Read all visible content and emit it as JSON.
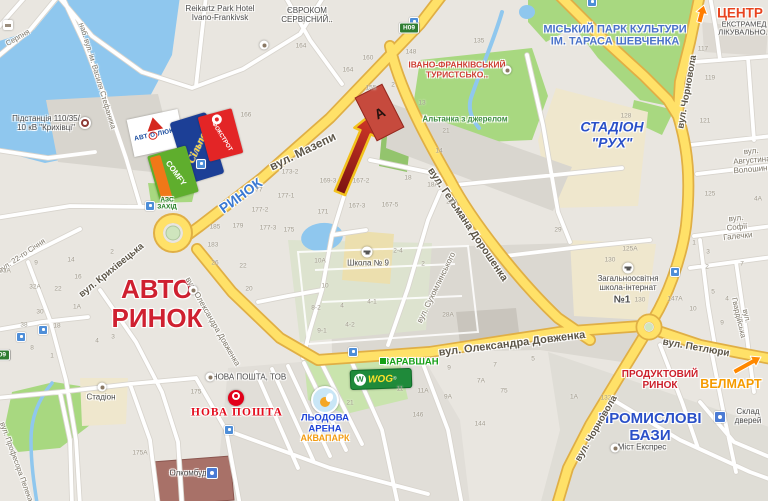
{
  "marker": {
    "letter": "А"
  },
  "colors": {
    "water": "#8fc7ee",
    "park": "#a8d880",
    "road_major": "#ffe168",
    "road_major_casing": "#e0af45",
    "road_minor": "#ffffff",
    "land": "#e9e6e0",
    "tan_poi": "#efe7cd",
    "accent_red": "#cf2030",
    "accent_blue": "#2a50c8",
    "accent_orange": "#ff7d00"
  },
  "area_labels": [
    {
      "name": "park-shevchenko-label",
      "text": "МІСЬКИЙ ПАРК КУЛЬТУРИ\nІМ. ТАРАСА ШЕВЧЕНКА",
      "x": 615,
      "y": 36,
      "size": 11,
      "color": "#4a72c8"
    },
    {
      "name": "stadion-rukh-label",
      "text": "СТАДІОН\n\"РУХ\"",
      "x": 612,
      "y": 135,
      "size": 14,
      "color": "#2a50c8",
      "italic": true
    },
    {
      "name": "avto-rynok-label",
      "text": "АВТО\nРИНОК",
      "x": 157,
      "y": 304,
      "size": 26,
      "color": "#cf2030"
    },
    {
      "name": "rynok-label",
      "text": "РИНОК",
      "x": 241,
      "y": 196,
      "rot": -36,
      "size": 14,
      "color": "#3c7ad2"
    },
    {
      "name": "promyslovi-bazy-label",
      "text": "ПРОМИСЛОВІ\nБАЗИ",
      "x": 650,
      "y": 428,
      "size": 15,
      "color": "#2a50c8"
    },
    {
      "name": "produktovyi-rynok-label",
      "text": "ПРОДУКТОВИЙ\nРИНОК",
      "x": 660,
      "y": 380,
      "size": 10,
      "color": "#cc1f2a"
    },
    {
      "name": "velmart-label",
      "text": "ВЕЛМАРТ",
      "x": 731,
      "y": 384,
      "size": 12.5,
      "color": "#f59b00"
    },
    {
      "name": "centr-label",
      "text": "ЦЕНТР",
      "x": 740,
      "y": 13,
      "size": 13.5,
      "color": "#e8431e"
    },
    {
      "name": "turyst-poi-label",
      "text": "ІВАНО-ФРАНКІВСЬКИЙ\nТУРИСТСЬКО..",
      "x": 457,
      "y": 70,
      "size": 8.5,
      "color": "#ce3e33"
    },
    {
      "name": "altanka-label",
      "text": "Альтанка з джерелом",
      "x": 465,
      "y": 120,
      "size": 8,
      "color": "#3e8e41"
    },
    {
      "name": "zaravshan-label",
      "text": "ЗАРАВШАН",
      "x": 411,
      "y": 363,
      "size": 9.5,
      "color": "#17a017"
    },
    {
      "name": "lodova-arena-label",
      "text": "ЛЬОДОВА\nАРЕНА",
      "x": 325,
      "y": 424,
      "size": 9.5,
      "color": "#2145d8"
    },
    {
      "name": "akvapark-label",
      "text": "АКВАПАРК",
      "x": 325,
      "y": 438,
      "size": 9,
      "color": "#f39c12"
    },
    {
      "name": "nova-poshta-label",
      "text": "НОВА ПОШТА",
      "x": 237,
      "y": 413,
      "size": 11.5,
      "color": "#e30b1c",
      "serif": true,
      "spacing": 1
    },
    {
      "name": "azs-zahid-label",
      "text": "АЗС\nЗАХІД",
      "x": 167,
      "y": 204,
      "size": 6.5,
      "color": "#1c7a1c"
    }
  ],
  "street_labels": [
    {
      "name": "street-mazepy-label",
      "text": "вул. Мазепи",
      "x": 303,
      "y": 152,
      "rot": -26,
      "size": 12
    },
    {
      "name": "street-hetmana-doroshenka-label",
      "text": "вул. Гетьмана Дорошенка",
      "x": 467,
      "y": 225,
      "rot": 56,
      "size": 10.5
    },
    {
      "name": "street-chornovola-north-label",
      "text": "вул. Чорновола",
      "x": 688,
      "y": 92,
      "rot": -80,
      "size": 9.5
    },
    {
      "name": "street-chornovola-south-label",
      "text": "вул. Чорновола",
      "x": 597,
      "y": 429,
      "rot": -60,
      "size": 9.5
    },
    {
      "name": "street-dovzhenka-label",
      "text": "вул. Олександра Довженка",
      "x": 512,
      "y": 344,
      "rot": -7,
      "size": 11
    },
    {
      "name": "street-dovzhenka-west-label",
      "text": "вул. Олександра Довженка",
      "x": 212,
      "y": 322,
      "rot": 60,
      "size": 8,
      "bold": false,
      "color": "#7d7668"
    },
    {
      "name": "street-petliury-label",
      "text": "вул. Петлюри",
      "x": 696,
      "y": 348,
      "rot": 10,
      "size": 10
    },
    {
      "name": "street-kryhivetska-label",
      "text": "вул. Крихівецька",
      "x": 112,
      "y": 271,
      "rot": -39,
      "size": 9.5
    },
    {
      "name": "street-stefanyka-label",
      "text": "наб. вул. ім. Василя Стефаника",
      "x": 97,
      "y": 76,
      "rot": 73,
      "size": 7.5,
      "bold": false,
      "color": "#7d7668"
    },
    {
      "name": "street-sukhomlynskoho-label",
      "text": "вул. Сухомлинського",
      "x": 437,
      "y": 288,
      "rot": -64,
      "size": 8,
      "bold": false,
      "color": "#7d7668"
    },
    {
      "name": "street-voloshyna-label",
      "text": "вул. Августина Волошина",
      "x": 752,
      "y": 161,
      "rot": -5,
      "size": 8,
      "bold": false,
      "color": "#7d7668"
    },
    {
      "name": "street-halechky-label",
      "text": "вул. Софії Галечки",
      "x": 737,
      "y": 228,
      "rot": -6,
      "size": 8,
      "bold": false,
      "color": "#7d7668"
    },
    {
      "name": "street-hvardiiska-label",
      "text": "вул. Гвардійська",
      "x": 742,
      "y": 317,
      "rot": 77,
      "size": 7.5,
      "bold": false,
      "color": "#7d7668"
    },
    {
      "name": "street-22-sichnya-label",
      "text": "вул. 22-го Січня",
      "x": 22,
      "y": 256,
      "rot": -34,
      "size": 7.5,
      "bold": false,
      "color": "#7d7668"
    },
    {
      "name": "street-pelekha-label",
      "text": "вул. Професора Пелека",
      "x": 16,
      "y": 462,
      "rot": 70,
      "size": 7.5,
      "bold": false,
      "color": "#7d7668"
    },
    {
      "name": "street-serpnya-label",
      "text": "Серпня",
      "x": 18,
      "y": 38,
      "rot": -30,
      "size": 7.5,
      "bold": false,
      "color": "#7d7668"
    }
  ],
  "poi_labels": [
    {
      "name": "reikartz-hotel-label",
      "text": "Reikartz Park Hotel\nIvano-Frankivsk",
      "x": 220,
      "y": 14
    },
    {
      "name": "evrokom-label",
      "text": "ЄВРОКОМ\nСЕРВІСНИЙ..",
      "x": 307,
      "y": 16
    },
    {
      "name": "ekstramed-label",
      "text": "ЕКСТРАМЕД\nЛІКУВАЛЬНО..",
      "x": 744,
      "y": 29,
      "size": 7.5
    },
    {
      "name": "pidstantsiya-label",
      "text": "Підстанція 110/35/\n10 кВ \"Крихівці\"",
      "x": 46,
      "y": 124
    },
    {
      "name": "shkola-9-label",
      "text": "Школа № 9",
      "x": 368,
      "y": 264
    },
    {
      "name": "internat-label",
      "text": "Загальноосвітня\nшкола-інтернат",
      "x": 628,
      "y": 284
    },
    {
      "name": "internat-n1-label",
      "text": "№1",
      "x": 622,
      "y": 300,
      "size": 10,
      "bold": true
    },
    {
      "name": "nova-poshta-tov-label",
      "text": "НОВА ПОШТА, ТОВ",
      "x": 249,
      "y": 378
    },
    {
      "name": "stadion-label",
      "text": "Стадіон",
      "x": 101,
      "y": 398
    },
    {
      "name": "olkombud-label",
      "text": "Олкомбуд",
      "x": 188,
      "y": 474
    },
    {
      "name": "mist-ekspres-label",
      "text": "Міст Експрес",
      "x": 642,
      "y": 448
    },
    {
      "name": "sklad-dverei-label",
      "text": "Склад дверей",
      "x": 748,
      "y": 417
    }
  ],
  "house_numbers": [
    [
      "166",
      246,
      115
    ],
    [
      "164",
      301,
      46
    ],
    [
      "160",
      368,
      58
    ],
    [
      "148",
      411,
      52
    ],
    [
      "135",
      479,
      41
    ],
    [
      "164",
      348,
      70
    ],
    [
      "155",
      371,
      88
    ],
    [
      "2",
      393,
      85
    ],
    [
      "13",
      422,
      103
    ],
    [
      "21",
      446,
      131
    ],
    [
      "14",
      439,
      151
    ],
    [
      "18А",
      433,
      185
    ],
    [
      "18",
      408,
      178
    ],
    [
      "2-4",
      398,
      251
    ],
    [
      "2",
      423,
      264
    ],
    [
      "22А",
      452,
      202
    ],
    [
      "29",
      558,
      230
    ],
    [
      "28А",
      448,
      315
    ],
    [
      "173-2",
      290,
      172
    ],
    [
      "177-1",
      286,
      196
    ],
    [
      "177-2",
      260,
      210
    ],
    [
      "177-3",
      268,
      228
    ],
    [
      "175",
      289,
      230
    ],
    [
      "169-3",
      328,
      181
    ],
    [
      "167-2",
      361,
      181
    ],
    [
      "167-3",
      357,
      206
    ],
    [
      "167-5",
      390,
      205
    ],
    [
      "171",
      323,
      212
    ],
    [
      "10А",
      320,
      261
    ],
    [
      "10",
      325,
      286
    ],
    [
      "8-2",
      316,
      308
    ],
    [
      "4",
      342,
      306
    ],
    [
      "4-1",
      372,
      302
    ],
    [
      "4-2",
      350,
      325
    ],
    [
      "9-1",
      322,
      331
    ],
    [
      "77",
      259,
      190
    ],
    [
      "185",
      215,
      227
    ],
    [
      "179",
      238,
      226
    ],
    [
      "183",
      213,
      245
    ],
    [
      "26",
      215,
      263
    ],
    [
      "22",
      243,
      266
    ],
    [
      "20",
      249,
      289
    ],
    [
      "2",
      112,
      252
    ],
    [
      "22",
      58,
      289
    ],
    [
      "16",
      78,
      277
    ],
    [
      "14",
      71,
      260
    ],
    [
      "9",
      36,
      263
    ],
    [
      "32А",
      35,
      287
    ],
    [
      "33А",
      5,
      271
    ],
    [
      "30",
      40,
      312
    ],
    [
      "38",
      24,
      325
    ],
    [
      "18",
      57,
      326
    ],
    [
      "1А",
      77,
      307
    ],
    [
      "8",
      32,
      348
    ],
    [
      "1",
      52,
      356
    ],
    [
      "4",
      97,
      341
    ],
    [
      "3",
      113,
      337
    ],
    [
      "117",
      703,
      49
    ],
    [
      "119",
      710,
      78
    ],
    [
      "121",
      705,
      121
    ],
    [
      "125",
      710,
      194
    ],
    [
      "4А",
      758,
      199
    ],
    [
      "128",
      626,
      116
    ],
    [
      "130",
      610,
      260
    ],
    [
      "125А",
      630,
      249
    ],
    [
      "130",
      640,
      300
    ],
    [
      "147А",
      675,
      299
    ],
    [
      "10",
      693,
      309
    ],
    [
      "5",
      713,
      292
    ],
    [
      "4",
      727,
      299
    ],
    [
      "2",
      707,
      267
    ],
    [
      "1",
      694,
      243
    ],
    [
      "3",
      708,
      252
    ],
    [
      "7",
      742,
      264
    ],
    [
      "9",
      722,
      323
    ],
    [
      "11",
      400,
      389
    ],
    [
      "11А",
      423,
      391
    ],
    [
      "9А",
      448,
      397
    ],
    [
      "9",
      449,
      368
    ],
    [
      "7",
      495,
      365
    ],
    [
      "7А",
      481,
      381
    ],
    [
      "5",
      533,
      359
    ],
    [
      "75",
      504,
      391
    ],
    [
      "146",
      418,
      415
    ],
    [
      "144",
      480,
      424
    ],
    [
      "21",
      350,
      403
    ],
    [
      "175",
      196,
      392
    ],
    [
      "175А",
      140,
      453
    ],
    [
      "1А",
      574,
      397
    ],
    [
      "132",
      606,
      398
    ]
  ],
  "icons": {
    "transit_stops": [
      [
        201,
        164
      ],
      [
        675,
        272
      ],
      [
        353,
        352
      ],
      [
        229,
        430
      ],
      [
        43,
        330
      ],
      [
        21,
        337
      ],
      [
        414,
        22
      ],
      [
        592,
        2
      ],
      [
        150,
        206
      ]
    ],
    "poi_dots": [
      [
        264,
        45
      ],
      [
        507,
        70
      ],
      [
        193,
        290
      ],
      [
        102,
        387
      ],
      [
        210,
        377
      ],
      [
        615,
        448
      ]
    ],
    "schools": [
      [
        367,
        252
      ],
      [
        628,
        268
      ]
    ],
    "blue_pois": [
      [
        212,
        473
      ],
      [
        720,
        417
      ]
    ],
    "lodging": [
      8,
      25
    ],
    "substation": [
      85,
      123
    ],
    "zaravshan_marker": [
      383,
      361
    ],
    "road_shields": [
      {
        "text": "Н09",
        "x": 409,
        "y": 28
      },
      {
        "text": "Н09",
        "x": 0,
        "y": 355
      }
    ]
  },
  "logos": {
    "avtoluks": {
      "part1": "АВТ",
      "part2": "О",
      "part3": "ЛЮКС"
    },
    "silpo": {
      "text": "Сільпо"
    },
    "foxtrot": {
      "text": "ФОКСТРОТ"
    },
    "comfy": {
      "text": "COMFY"
    },
    "wog": {
      "w": "W",
      "text": "WOG",
      "reg": "®"
    }
  }
}
